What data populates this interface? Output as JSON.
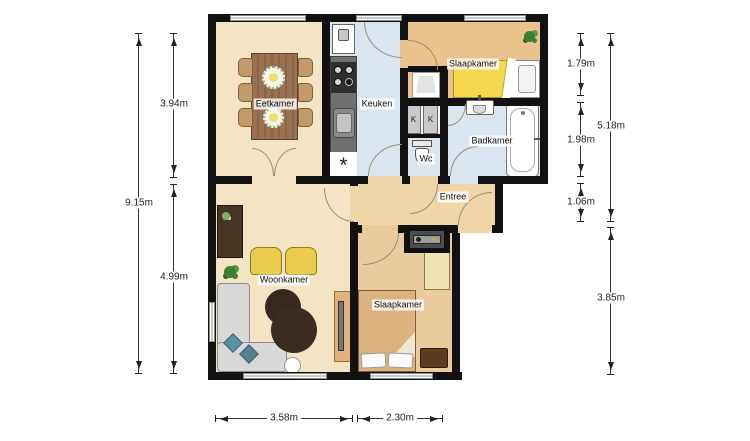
{
  "rooms": {
    "eetkamer": "Eetkamer",
    "keuken": "Keuken",
    "slaapkamer_top": "Slaapkamer",
    "badkamer": "Badkamer",
    "wc": "Wc",
    "kast_1": "K",
    "kast_2": "K",
    "entree": "Entree",
    "woonkamer": "Woonkamer",
    "slaapkamer_bottom": "Slaapkamer"
  },
  "dimensions": {
    "left_total": "9.15m",
    "left_top": "3.94m",
    "left_bottom": "4.99m",
    "right_top": "1.79m",
    "right_middle": "1.98m",
    "right_small": "1.06m",
    "right_upper_total": "5.18m",
    "right_lower_total": "3.85m",
    "bottom_left": "3.58m",
    "bottom_right": "2.30m"
  },
  "symbols": {
    "washer_connection": "*"
  },
  "colors": {
    "wall": "#111111",
    "floor_living": "#f3e4c4",
    "floor_wet": "#dbe5f0",
    "floor_bedroom_top": "#e9c28c",
    "floor_bedroom_bottom": "#ebca9d",
    "floor_entree": "#f0d5a8",
    "bed_yellow": "#f6d84f",
    "chair_yellow": "#e9cc4b",
    "sofa_gray": "#d8d8d8",
    "cushion_teal": "#5e8fa0",
    "rug_brown": "#36291f",
    "table_brown": "#9a7252"
  }
}
